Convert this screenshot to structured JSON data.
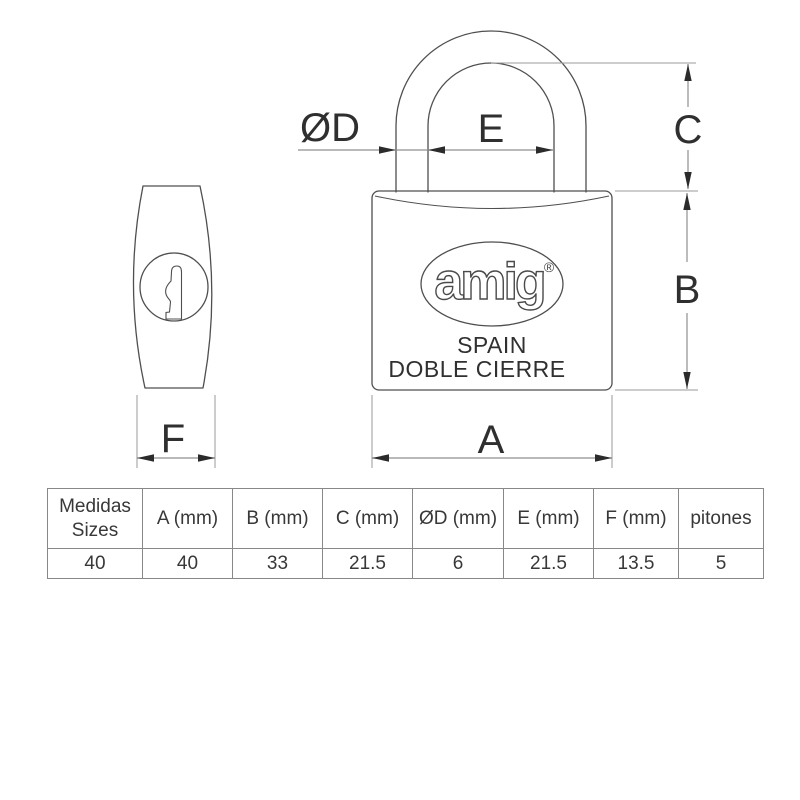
{
  "drawing": {
    "dimension_labels": {
      "d": "ØD",
      "e": "E",
      "c": "C",
      "b": "B",
      "a": "A",
      "f": "F"
    },
    "lock_markings": {
      "brand": "amig",
      "registered": "®",
      "country": "SPAIN",
      "feature": "DOBLE CIERRE"
    },
    "colors": {
      "outline": "#4f4f4f",
      "dimension_line": "#8f8f8f",
      "arrow": "#2b2b2b",
      "label_text": "#2f2f2f"
    }
  },
  "table": {
    "border_color": "#888888",
    "columns": [
      {
        "header_line1": "Medidas",
        "header_line2": "Sizes",
        "value": "40"
      },
      {
        "header": "A (mm)",
        "value": "40"
      },
      {
        "header": "B (mm)",
        "value": "33"
      },
      {
        "header": "C (mm)",
        "value": "21.5"
      },
      {
        "header": "ØD (mm)",
        "value": "6"
      },
      {
        "header": "E (mm)",
        "value": "21.5"
      },
      {
        "header": "F (mm)",
        "value": "13.5"
      },
      {
        "header": "pitones",
        "value": "5"
      }
    ]
  }
}
